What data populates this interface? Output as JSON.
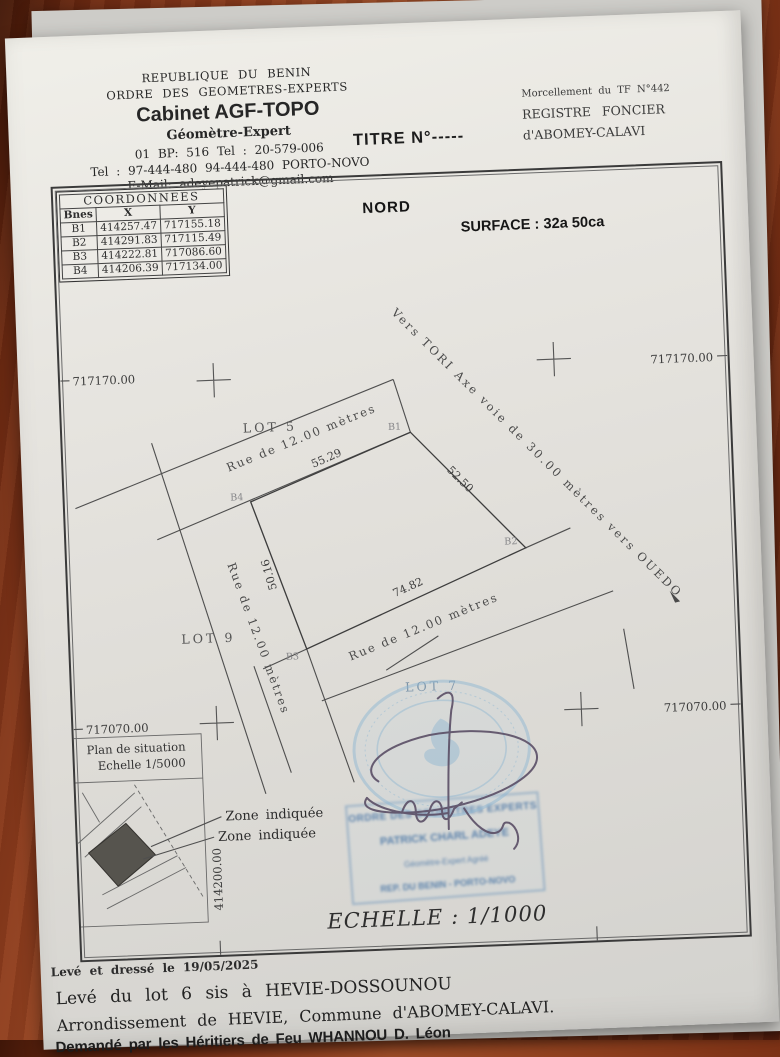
{
  "header": {
    "org1": "REPUBLIQUE DU BENIN",
    "org2": "ORDRE DES GEOMETRES-EXPERTS",
    "cabinet": "Cabinet AGF-TOPO",
    "role": "Géomètre-Expert",
    "addr1": "01 BP: 516  Tel : 20-579-006",
    "addr2": "Tel : 97-444-480  94-444-480  PORTO-NOVO",
    "email": "E-Mail: adeyepatrick@gmail.com",
    "titre": "TITRE N°-----",
    "morcellement": "Morcellement du TF N°442",
    "registre1": "REGISTRE FONCIER",
    "registre2": "d'ABOMEY-CALAVI"
  },
  "plan": {
    "nord": "NORD",
    "surface": "SURFACE  : 32a 50ca",
    "table": {
      "title": "COORDONNEES",
      "cols": [
        "Bnes",
        "X",
        "Y"
      ],
      "rows": [
        [
          "B1",
          "414257.47",
          "717155.18"
        ],
        [
          "B2",
          "414291.83",
          "717115.49"
        ],
        [
          "B3",
          "414222.81",
          "717086.60"
        ],
        [
          "B4",
          "414206.39",
          "717134.00"
        ]
      ]
    },
    "grid": {
      "y_north": "717170.00",
      "y_south": "717070.00",
      "x_west": "414200.00"
    },
    "lots": {
      "lot5": "LOT 5",
      "lot9": "LOT 9",
      "lot7": "LOT 7"
    },
    "rue": "Rue  de  12.00  mètres",
    "axe": "Vers TORI  Axe  voie  de  30.00  mètres  vers  OUEDO",
    "dims": {
      "b4b1": "55.29",
      "b1b2": "52.50",
      "b2b3": "74.82",
      "b3b4": "50.16"
    },
    "corners": {
      "b1": "B1",
      "b2": "B2",
      "b3": "B3",
      "b4": "B4"
    },
    "inset": {
      "title": "Plan de situation",
      "scale": "Echelle 1/5000"
    },
    "zone": "Zone  indiquée",
    "echelle": "ECHELLE : 1/1000",
    "stamp_rect": {
      "line1": "ORDRE DES GEOMETRES EXPERTS",
      "line2": "PATRICK  CHARL  ADEYE",
      "line3": "Géomètre-Expert Agréé",
      "line4": "REP. DU BENIN - PORTO-NOVO"
    }
  },
  "footer": {
    "line1": "Levé et dressé le 19/05/2025",
    "line2": "Levé du lot 6 sis à HEVIE-DOSSOUNOU",
    "line3": "Arrondissement de HEVIE, Commune d'ABOMEY-CALAVI.",
    "line4": "Demandé par les Héritiers de Feu WHANNOU D. Léon"
  }
}
